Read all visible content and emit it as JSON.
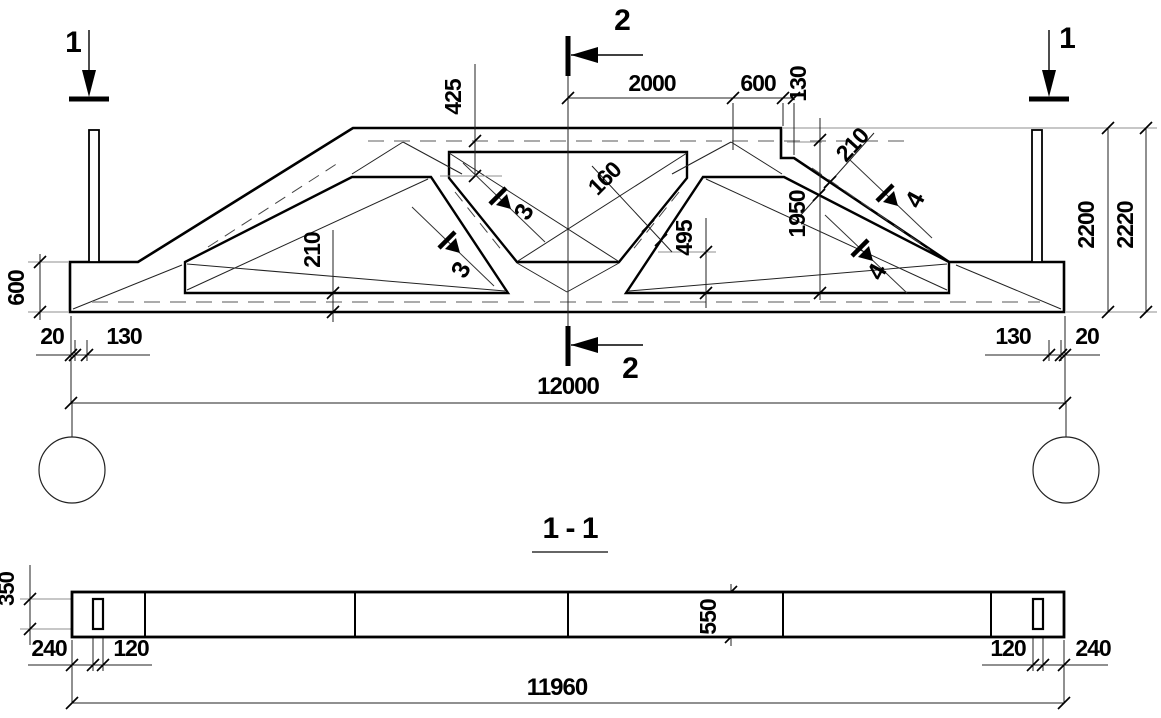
{
  "colors": {
    "ink": "#000000",
    "hairline": "#222222",
    "gray": "#8f8f8f",
    "background": "#ffffff"
  },
  "elevation": {
    "section_markers": [
      {
        "id": "sec1-left",
        "label": "1"
      },
      {
        "id": "sec2-top",
        "label": "2"
      },
      {
        "id": "sec1-right",
        "label": "1"
      },
      {
        "id": "sec2-bottom",
        "label": "2"
      }
    ],
    "cut_markers": [
      {
        "id": "cut3-upper",
        "label": "3"
      },
      {
        "id": "cut3-lower",
        "label": "3"
      },
      {
        "id": "cut4-upper",
        "label": "4"
      },
      {
        "id": "cut4-lower",
        "label": "4"
      }
    ],
    "dimensions": [
      {
        "id": "d425",
        "value": "425"
      },
      {
        "id": "d2000",
        "value": "2000"
      },
      {
        "id": "d600top",
        "value": "600"
      },
      {
        "id": "d130top",
        "value": "130"
      },
      {
        "id": "d210r",
        "value": "210"
      },
      {
        "id": "d1950",
        "value": "1950"
      },
      {
        "id": "d160",
        "value": "160"
      },
      {
        "id": "d495",
        "value": "495"
      },
      {
        "id": "d210b",
        "value": "210"
      },
      {
        "id": "d600l",
        "value": "600"
      },
      {
        "id": "d20l",
        "value": "20"
      },
      {
        "id": "d130l",
        "value": "130"
      },
      {
        "id": "d130r",
        "value": "130"
      },
      {
        "id": "d20r",
        "value": "20"
      },
      {
        "id": "d12000",
        "value": "12000"
      },
      {
        "id": "d2200",
        "value": "2200"
      },
      {
        "id": "d2220",
        "value": "2220"
      }
    ]
  },
  "section": {
    "title": "1 - 1",
    "dimensions": [
      {
        "id": "d350",
        "value": "350"
      },
      {
        "id": "d240l",
        "value": "240"
      },
      {
        "id": "d120l",
        "value": "120"
      },
      {
        "id": "d550",
        "value": "550"
      },
      {
        "id": "d120r",
        "value": "120"
      },
      {
        "id": "d240r",
        "value": "240"
      },
      {
        "id": "d11960",
        "value": "11960"
      }
    ]
  }
}
